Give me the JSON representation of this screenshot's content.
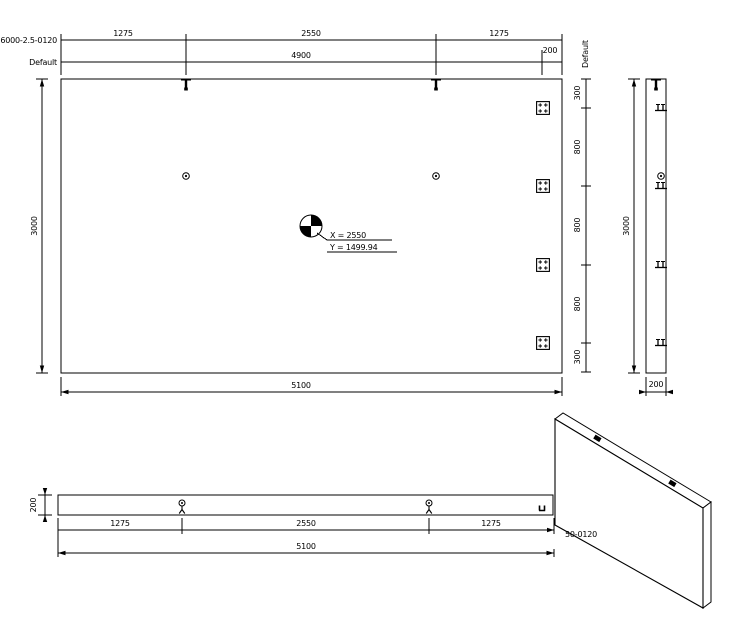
{
  "drawing": {
    "background": "#ffffff",
    "line_color": "#000000",
    "labels": {
      "chain_row": "6000-2.5-0120",
      "overall_row": "Default",
      "side_chain": "Default"
    },
    "plan": {
      "top_chain": [
        "1275",
        "2550",
        "1275"
      ],
      "overall_row": [
        "4900",
        "200"
      ],
      "left_height": "3000",
      "bottom_width": "5100",
      "right_chain": [
        "300",
        "800",
        "800",
        "800",
        "300"
      ],
      "cog": {
        "x_label": "X = 2550",
        "y_label": "Y = 1499.94"
      }
    },
    "side_view": {
      "height": "3000",
      "width": "200"
    },
    "front_view": {
      "height": "200",
      "chain": [
        "1275",
        "2550",
        "1275"
      ],
      "width": "5100"
    },
    "iso_view": {
      "label": "50-0120"
    }
  }
}
